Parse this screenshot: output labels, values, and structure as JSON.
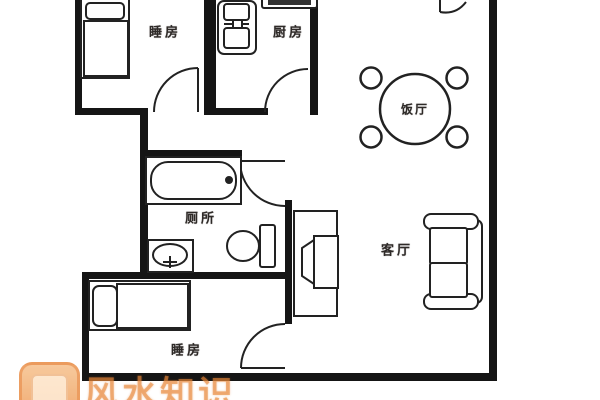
{
  "title": "apartment-floor-plan",
  "floor_plan": {
    "rooms": [
      {
        "id": "bedroom-top",
        "label": "睡房"
      },
      {
        "id": "kitchen",
        "label": "厨房"
      },
      {
        "id": "dining-room",
        "label": "饭厅"
      },
      {
        "id": "bathroom",
        "label": "厕所"
      },
      {
        "id": "living-room",
        "label": "客厅"
      },
      {
        "id": "bedroom-bottom",
        "label": "睡房"
      }
    ],
    "fixtures": [
      "bed",
      "stove-sink-unit",
      "kitchen-counter",
      "round-dining-table",
      "dining-chairs",
      "bathtub",
      "wash-basin",
      "toilet",
      "tv-cabinet",
      "tv-set",
      "sofa",
      "door-swing-arcs"
    ],
    "door_count": 5
  },
  "watermark": {
    "text": "风水知识",
    "logo": "fengshui-site-logo",
    "color": "#e98a3c"
  },
  "colors": {
    "background": "#ffffff",
    "wall": "#151515",
    "line": "#222222",
    "label": "#2e2a28",
    "watermark_orange": "#e98a3c"
  }
}
